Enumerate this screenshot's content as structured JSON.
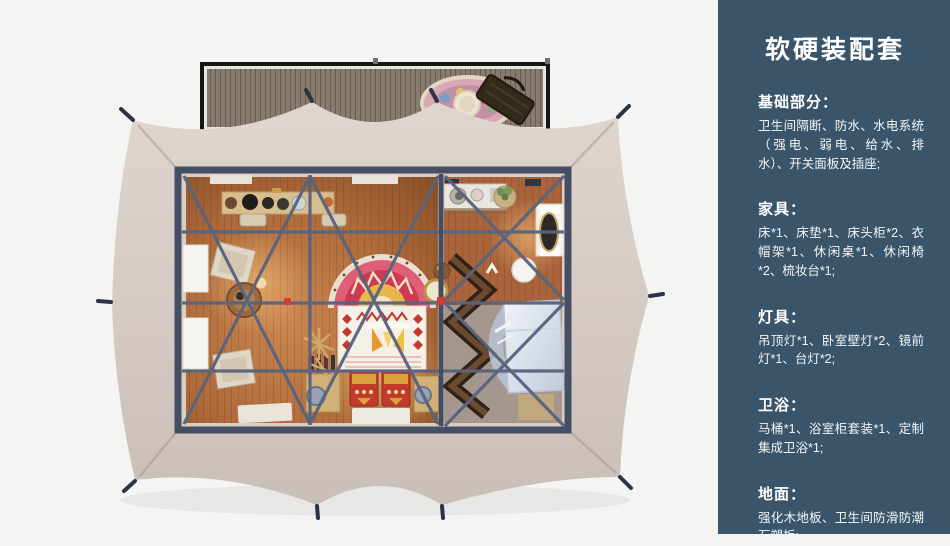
{
  "panel": {
    "title": "软硬装配套",
    "bg_color": "#3a556a",
    "text_color": "#ffffff",
    "sections": [
      {
        "heading": "基础部分：",
        "body": "卫生间隔断、防水、水电系统（强电、弱电、给水、排水）、开关面板及插座;"
      },
      {
        "heading": "家具：",
        "body": "床*1、床垫*1、床头柜*2、衣帽架*1、休闲桌*1、休闲椅*2、梳妆台*1;"
      },
      {
        "heading": "灯具：",
        "body": "吊顶灯*1、卧室壁灯*2、镜前灯*1、台灯*2;"
      },
      {
        "heading": "卫浴：",
        "body": "马桶*1、浴室柜套装*1、定制集成卫浴*1;"
      },
      {
        "heading": "地面：",
        "body": "强化木地板、卫生间防滑防潮石塑板;"
      }
    ]
  },
  "floorplan": {
    "colors": {
      "background": "#f4f4f3",
      "tent_canvas": "#d7cec7",
      "roof_beam": "#59647e",
      "wood_floor": "#ad6a3b",
      "deck_wood": "#887b6e",
      "bed_accent_red": "#c23a2c",
      "rug_pink": "#df5f78",
      "shower_glass": "#d8dfe9",
      "joint_red": "#cc3f35"
    }
  }
}
